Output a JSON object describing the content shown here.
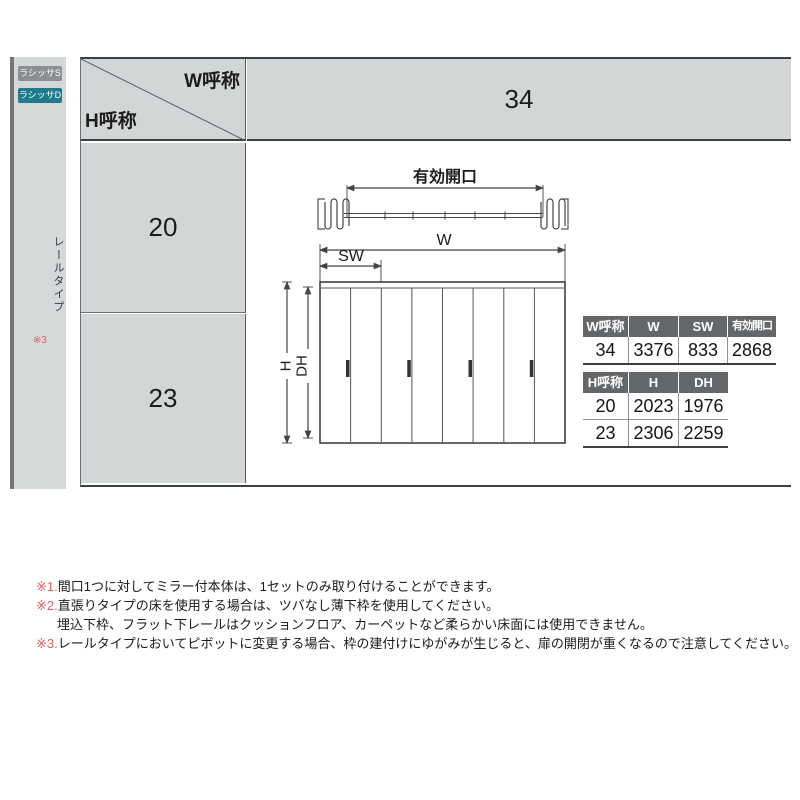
{
  "badges": {
    "s": "ラシッサS",
    "d": "ラシッサD"
  },
  "sidebar": {
    "rail_type": "レールタイプ",
    "note_ref": "※3"
  },
  "matrix": {
    "w_axis": "W呼称",
    "h_axis": "H呼称",
    "w_value": "34",
    "h_row1": "20",
    "h_row2": "23"
  },
  "diagram": {
    "effective_opening": "有効開口",
    "w": "W",
    "sw": "SW",
    "h": "H",
    "dh": "DH"
  },
  "w_table": {
    "headers": [
      "W呼称",
      "W",
      "SW",
      "有効開口"
    ],
    "row": [
      "34",
      "3376",
      "833",
      "2868"
    ]
  },
  "h_table": {
    "headers": [
      "H呼称",
      "H",
      "DH"
    ],
    "rows": [
      [
        "20",
        "2023",
        "1976"
      ],
      [
        "23",
        "2306",
        "2259"
      ]
    ]
  },
  "notes": [
    {
      "prefix": "※1.",
      "text": "間口1つに対してミラー付本体は、1セットのみ取り付けることができます。"
    },
    {
      "prefix": "※2.",
      "text": "直張りタイプの床を使用する場合は、ツバなし薄下枠を使用してください。"
    },
    {
      "prefix": "",
      "text": "埋込下枠、フラット下レールはクッションフロア、カーペットなど柔らかい床面には使用できません。"
    },
    {
      "prefix": "※3.",
      "text": "レールタイプにおいてピボットに変更する場合、枠の建付けにゆがみが生じると、扉の開閉が重くなるので注意してください。"
    }
  ],
  "colors": {
    "cell_gray": "#d3d6d7",
    "table_header_gray": "#64676a",
    "badge_s_gray": "#8b8f92",
    "badge_d_teal": "#1e7b8c",
    "note_red": "#d9625c",
    "line_dark": "#3c4043"
  }
}
